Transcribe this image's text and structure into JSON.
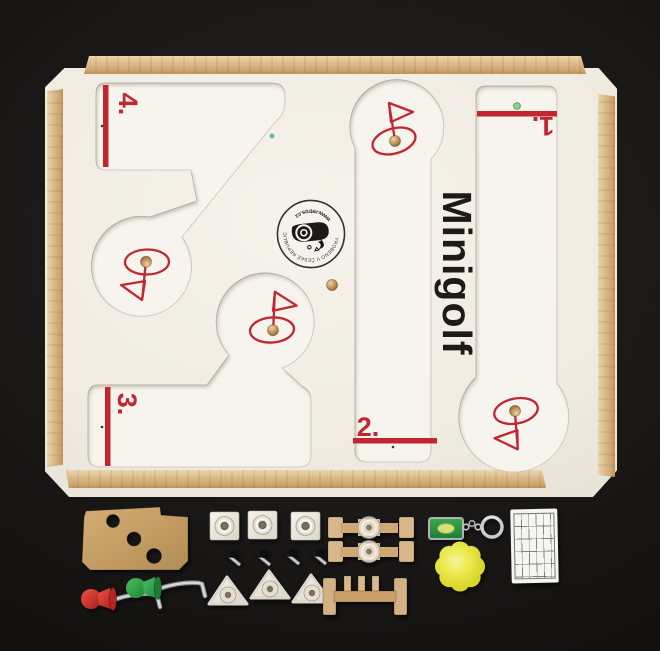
{
  "photo": {
    "subject": "Wooden tabletop minigolf game set photographed from above on a black background",
    "board": {
      "title": "Minigolf",
      "stamp": {
        "maker_text": "VYROBENO V ČESKÉ REPUBLICE",
        "url_text": "www.retros.cz"
      },
      "holes": [
        {
          "id": "hole-1",
          "label": "1."
        },
        {
          "id": "hole-2",
          "label": "2."
        },
        {
          "id": "hole-3",
          "label": "3."
        },
        {
          "id": "hole-4",
          "label": "4."
        }
      ]
    },
    "accessories": [
      {
        "name": "mdf-target-board",
        "count": 1
      },
      {
        "name": "red-club",
        "count": 1
      },
      {
        "name": "green-club",
        "count": 1
      },
      {
        "name": "square-bumper-tile",
        "count": 3
      },
      {
        "name": "black-thumb-screw",
        "count": 4
      },
      {
        "name": "triangle-bumper-tile",
        "count": 3
      },
      {
        "name": "spinner-paddle",
        "count": 2
      },
      {
        "name": "gate-obstacle",
        "count": 1
      },
      {
        "name": "level-keychain",
        "count": 1
      },
      {
        "name": "foam-flower-ball",
        "count": 1
      },
      {
        "name": "score-card",
        "count": 1
      }
    ],
    "colors": {
      "background": "#151311",
      "board": "#f2efe8",
      "wood": "#dcbd8f",
      "accent-red": "#c22630",
      "ink-black": "#1d1a17",
      "club-red": "#d03028",
      "club-green": "#2f9e41",
      "sponge-yellow": "#eae73c",
      "ball-wood": "#c89a5f"
    }
  }
}
